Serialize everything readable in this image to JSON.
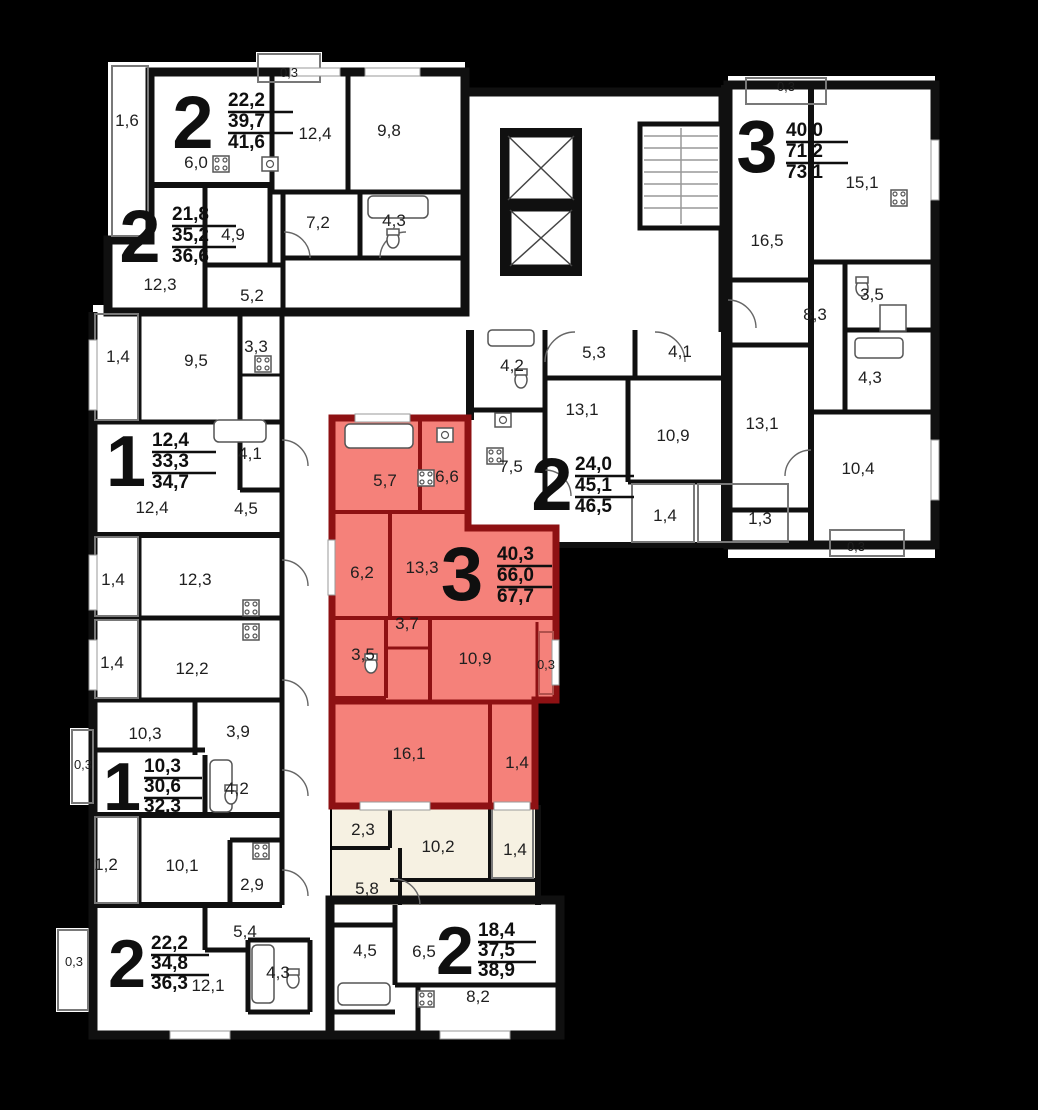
{
  "plan_title": "residential floor plan",
  "colors": {
    "background": "#000000",
    "floor": "#ffffff",
    "floor_tint": "#f6f1e2",
    "wall": "#101010",
    "highlight_fill": "#f5817a",
    "highlight_wall": "#8e1113",
    "label_text": "#1f1f1f"
  },
  "apartments": [
    {
      "name": "top-left-2room",
      "rooms": "2",
      "living": "22,2",
      "usable": "39,7",
      "total": "41,6",
      "highlighted": false
    },
    {
      "name": "left-2room",
      "rooms": "2",
      "living": "21,8",
      "usable": "35,2",
      "total": "36,6",
      "highlighted": false
    },
    {
      "name": "right-3room",
      "rooms": "3",
      "living": "40,0",
      "usable": "71,2",
      "total": "73,1",
      "highlighted": false
    },
    {
      "name": "left-1room",
      "rooms": "1",
      "living": "12,4",
      "usable": "33,3",
      "total": "34,7",
      "highlighted": false
    },
    {
      "name": "middle-2room",
      "rooms": "2",
      "living": "24,0",
      "usable": "45,1",
      "total": "46,5",
      "highlighted": false
    },
    {
      "name": "highlighted-3room",
      "rooms": "3",
      "living": "40,3",
      "usable": "66,0",
      "total": "67,7",
      "highlighted": true
    },
    {
      "name": "bottom-left-1room",
      "rooms": "1",
      "living": "10,3",
      "usable": "30,6",
      "total": "32,3",
      "highlighted": false
    },
    {
      "name": "bottom-left-2room",
      "rooms": "2",
      "living": "22,2",
      "usable": "34,8",
      "total": "36,3",
      "highlighted": false
    },
    {
      "name": "bottom-right-2room",
      "rooms": "2",
      "living": "18,4",
      "usable": "37,5",
      "total": "38,9",
      "highlighted": false
    }
  ],
  "room_areas": [
    {
      "area": "1,6"
    },
    {
      "area": "0,3"
    },
    {
      "area": "12,4"
    },
    {
      "area": "9,8"
    },
    {
      "area": "6,0"
    },
    {
      "area": "4,9"
    },
    {
      "area": "7,2"
    },
    {
      "area": "4,3"
    },
    {
      "area": "12,3"
    },
    {
      "area": "5,2"
    },
    {
      "area": "0,3"
    },
    {
      "area": "16,5"
    },
    {
      "area": "15,1"
    },
    {
      "area": "8,3"
    },
    {
      "area": "3,5"
    },
    {
      "area": "4,3"
    },
    {
      "area": "13,1"
    },
    {
      "area": "10,4"
    },
    {
      "area": "0,3"
    },
    {
      "area": "1,3"
    },
    {
      "area": "5,3"
    },
    {
      "area": "4,1"
    },
    {
      "area": "4,2"
    },
    {
      "area": "13,1"
    },
    {
      "area": "7,5"
    },
    {
      "area": "10,9"
    },
    {
      "area": "1,4"
    },
    {
      "area": "1,4"
    },
    {
      "area": "9,5"
    },
    {
      "area": "3,3"
    },
    {
      "area": "4,1"
    },
    {
      "area": "12,4"
    },
    {
      "area": "4,5"
    },
    {
      "area": "1,4"
    },
    {
      "area": "12,3"
    },
    {
      "area": "1,4"
    },
    {
      "area": "12,2"
    },
    {
      "area": "10,3"
    },
    {
      "area": "3,9"
    },
    {
      "area": "0,3"
    },
    {
      "area": "4,2"
    },
    {
      "area": "1,2"
    },
    {
      "area": "10,1"
    },
    {
      "area": "2,9"
    },
    {
      "area": "0,3"
    },
    {
      "area": "12,1"
    },
    {
      "area": "5,4"
    },
    {
      "area": "4,3"
    },
    {
      "area": "4,5"
    },
    {
      "area": "6,5"
    },
    {
      "area": "8,2"
    },
    {
      "area": "2,3"
    },
    {
      "area": "10,2"
    },
    {
      "area": "1,4"
    },
    {
      "area": "5,8"
    },
    {
      "area": "5,7"
    },
    {
      "area": "6,6"
    },
    {
      "area": "6,2"
    },
    {
      "area": "13,3"
    },
    {
      "area": "3,7"
    },
    {
      "area": "3,5"
    },
    {
      "area": "10,9"
    },
    {
      "area": "0,3"
    },
    {
      "area": "16,1"
    },
    {
      "area": "1,4"
    }
  ]
}
